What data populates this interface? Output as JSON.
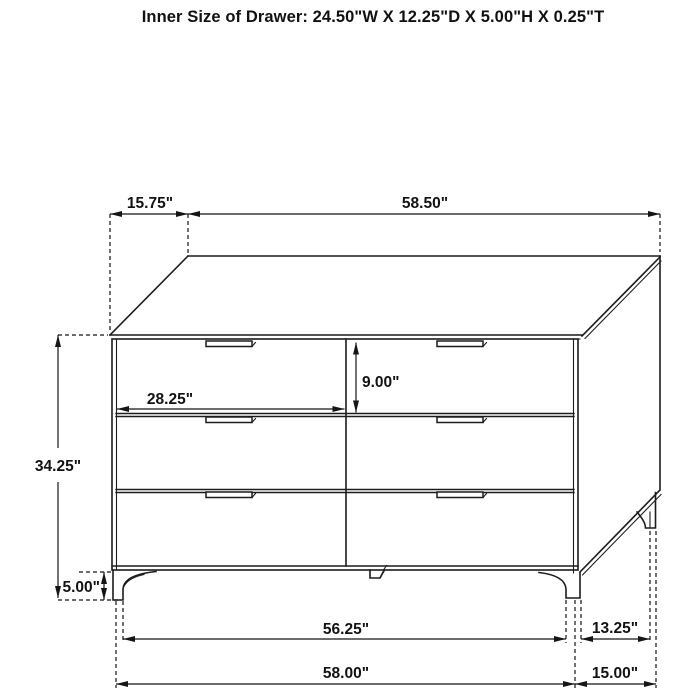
{
  "title": "Inner Size of Drawer: 24.50\"W X 12.25\"D X 5.00\"H X 0.25\"T",
  "colors": {
    "line": "#1c1c1c",
    "background": "#ffffff"
  },
  "diagram": {
    "type": "furniture-dimension-drawing",
    "subject": "six-drawer dresser",
    "dimensions": {
      "top_offset": "15.75\"",
      "top_width": "58.50\"",
      "overall_height": "34.25\"",
      "leg_height": "5.00\"",
      "drawer_height": "9.00\"",
      "drawer_width": "28.25\"",
      "base_inner_width": "56.25\"",
      "base_width": "58.00\"",
      "side_inner_depth": "13.25\"",
      "side_depth": "15.00\""
    }
  }
}
